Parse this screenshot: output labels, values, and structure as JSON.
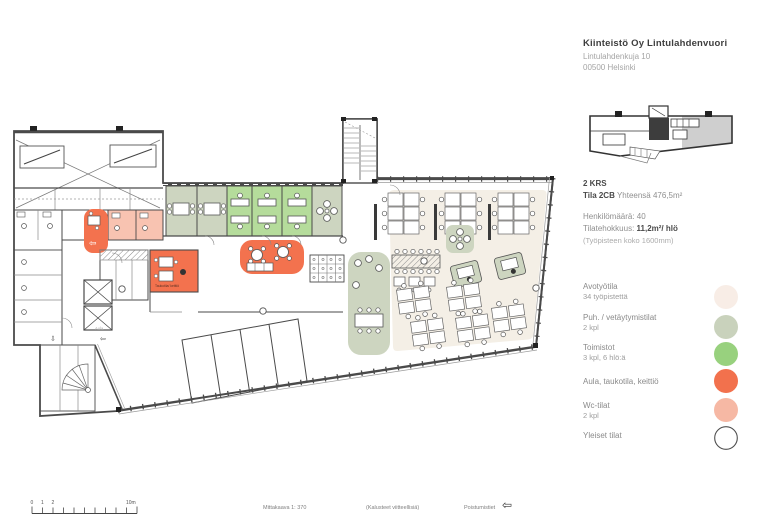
{
  "header": {
    "company": "Kiinteistö Oy Lintulahdenvuori",
    "address1": "Lintulahdenkuja 10",
    "address2": "00500 Helsinki"
  },
  "info": {
    "floor": "2 KRS",
    "space": "Tila 2CB",
    "total": " Yhteensä 476,5m²",
    "headcount": "Henkilömäärä: 40",
    "eff_label": "Tilatehokkuus: ",
    "eff_value": "11,2m²/ hlö",
    "note": "(Työpisteen koko 1600mm)"
  },
  "legend": {
    "items": [
      {
        "label": "Avotyötila",
        "sub": "34 työpistettä",
        "color": "#f8ede6"
      },
      {
        "label": "Puh. / vetäytymistilat",
        "sub": "2 kpl",
        "color": "#c9d2bc"
      },
      {
        "label": "Toimistot",
        "sub": "3 kpl, 6 hlö:ä",
        "color": "#98d17e"
      },
      {
        "label": "Aula, taukotila, keittiö",
        "sub": "",
        "color": "#f2714d"
      },
      {
        "label": "Wc-tilat",
        "sub": "2 kpl",
        "color": "#f6b8a4"
      },
      {
        "label": "Yleiset tilat",
        "sub": "",
        "color": "#ffffff"
      }
    ]
  },
  "plan": {
    "labels": {
      "aula": "Aula",
      "taukotila": "Taukotila/ keittiö"
    },
    "arrow_left": "⇦",
    "arrow_down": "⇩",
    "colors": {
      "open": "#f4efe6",
      "sage": "#cdd5c0",
      "green": "#b5dc9b",
      "orange": "#f3724e",
      "salmon": "#f8c3b1",
      "wall": "#4a4a4a"
    }
  },
  "scalebar": {
    "l0": "0",
    "l1": "1",
    "l2": "2",
    "l10": "10m"
  },
  "footer": {
    "scale": "Mittakaava 1: 370",
    "furniture": "(Kalusteet viitteellisiä)",
    "exits": "Poistumistiet",
    "arrow": "⇦"
  }
}
